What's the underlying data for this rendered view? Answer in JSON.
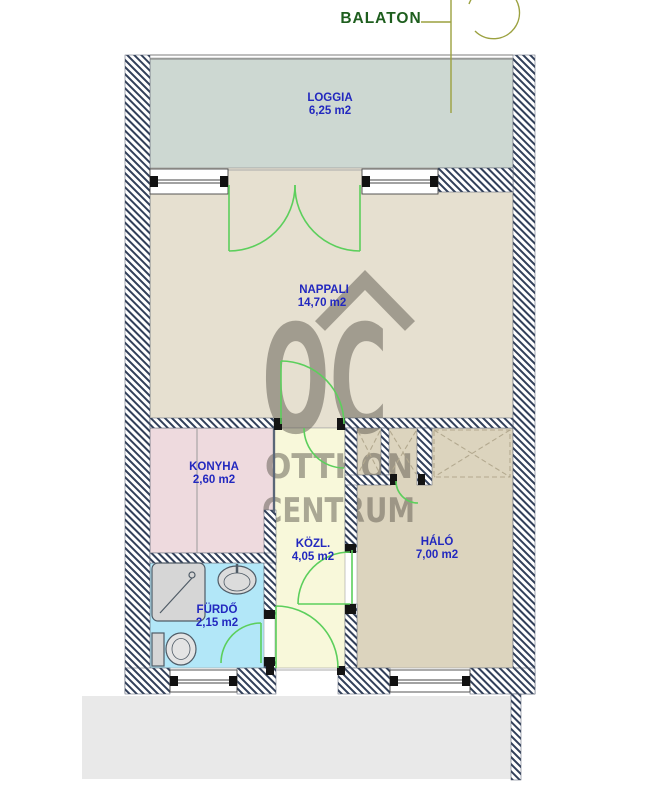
{
  "title": "BALATON",
  "watermark": {
    "letters": "OC",
    "line1": "OTTHON",
    "line2": "CENTRUM"
  },
  "rooms": [
    {
      "id": "loggia",
      "name": "LOGGIA",
      "area": "6,25 m2"
    },
    {
      "id": "nappali",
      "name": "NAPPALI",
      "area": "14,70 m2"
    },
    {
      "id": "konyha",
      "name": "KONYHA",
      "area": "2,60 m2"
    },
    {
      "id": "kozl",
      "name": "KÖZL.",
      "area": "4,05 m2"
    },
    {
      "id": "halo",
      "name": "HÁLÓ",
      "area": "7,00 m2"
    },
    {
      "id": "furdo",
      "name": "FÜRDŐ",
      "area": "2,15 m2"
    }
  ],
  "icons": {
    "compass": "north-compass"
  },
  "colors": {
    "loggia": "#cdd8d2",
    "nappali": "#e6e0d0",
    "konyha": "#eedade",
    "kozl": "#f8f8da",
    "halo": "#dcd4be",
    "furdo": "#b2e7f8",
    "gray_band": "#e9e9e9",
    "wall": "#32405a",
    "door": "#5ccf5c",
    "label": "#2228bf",
    "title": "#1e5e1e",
    "watermark": "#5f5a50",
    "compass": "#9ba13f"
  }
}
